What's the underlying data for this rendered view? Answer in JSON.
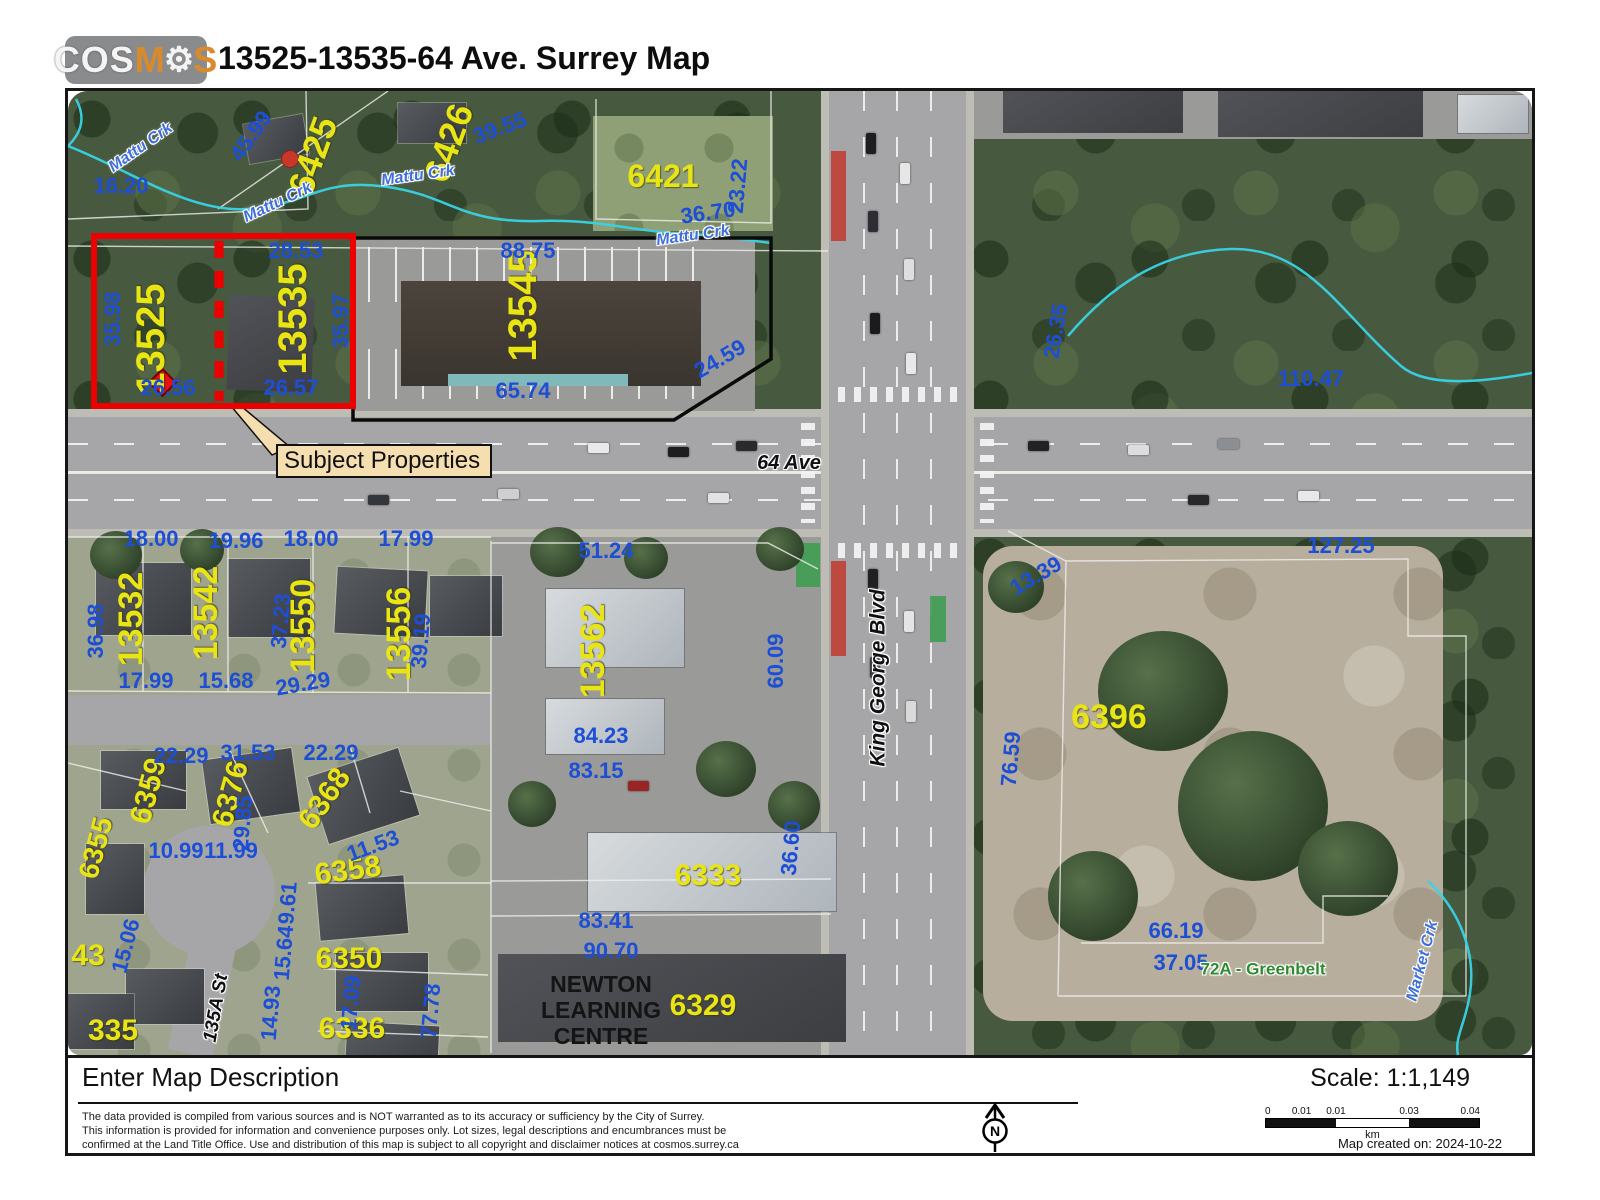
{
  "header": {
    "logo_parts": [
      {
        "t": "COS",
        "c": "lw"
      },
      {
        "t": "M",
        "c": "lo"
      },
      {
        "t": "⚙",
        "c": "lg"
      },
      {
        "t": "S",
        "c": "lo"
      }
    ],
    "title": "13525-13535-64 Ave. Surrey Map"
  },
  "map": {
    "colors": {
      "subject_outline": "#ee0000",
      "parcel_label": "#e9e414",
      "dimension_label": "#1d4ed6",
      "creek": "#39d3e6",
      "callout_fill": "#f5deb0",
      "greenbelt": "#2f8b2f"
    },
    "callout": {
      "text": "Subject Properties"
    },
    "building_label": {
      "lines": [
        "NEWTON",
        "LEARNING",
        "CENTRE"
      ]
    },
    "labels": [
      {
        "t": "6425",
        "x": 245,
        "y": 65,
        "r": -70,
        "k": "parcel",
        "s": 36
      },
      {
        "t": "6426",
        "x": 381,
        "y": 52,
        "r": -70,
        "k": "parcel",
        "s": 36
      },
      {
        "t": "6421",
        "x": 595,
        "y": 85,
        "k": "parcel",
        "s": 32
      },
      {
        "t": "13525",
        "x": 83,
        "y": 248,
        "r": -90,
        "k": "parcel",
        "s": 40
      },
      {
        "t": "13535",
        "x": 225,
        "y": 228,
        "r": -90,
        "k": "parcel",
        "s": 40
      },
      {
        "t": "13545",
        "x": 455,
        "y": 215,
        "r": -90,
        "k": "parcel",
        "s": 40
      },
      {
        "t": "13532",
        "x": 63,
        "y": 528,
        "r": -90,
        "k": "parcel",
        "s": 34
      },
      {
        "t": "13542",
        "x": 138,
        "y": 522,
        "r": -90,
        "k": "parcel",
        "s": 34
      },
      {
        "t": "13550",
        "x": 235,
        "y": 535,
        "r": -90,
        "k": "parcel",
        "s": 34
      },
      {
        "t": "13556",
        "x": 331,
        "y": 543,
        "r": -90,
        "k": "parcel",
        "s": 34
      },
      {
        "t": "13562",
        "x": 525,
        "y": 560,
        "r": -90,
        "k": "parcel",
        "s": 34
      },
      {
        "t": "6396",
        "x": 1041,
        "y": 626,
        "k": "parcel",
        "s": 34
      },
      {
        "t": "6359",
        "x": 81,
        "y": 700,
        "r": -75,
        "k": "parcel",
        "s": 30
      },
      {
        "t": "6376",
        "x": 163,
        "y": 703,
        "r": -75,
        "k": "parcel",
        "s": 30
      },
      {
        "t": "6368",
        "x": 257,
        "y": 708,
        "r": -55,
        "k": "parcel",
        "s": 30
      },
      {
        "t": "6358",
        "x": 280,
        "y": 780,
        "r": -8,
        "k": "parcel",
        "s": 30
      },
      {
        "t": "6350",
        "x": 281,
        "y": 868,
        "k": "parcel",
        "s": 30
      },
      {
        "t": "6336",
        "x": 284,
        "y": 938,
        "k": "parcel",
        "s": 30
      },
      {
        "t": "6355",
        "x": 28,
        "y": 757,
        "r": -75,
        "k": "parcel",
        "s": 28
      },
      {
        "t": "43",
        "x": 20,
        "y": 865,
        "k": "parcel",
        "s": 30
      },
      {
        "t": "335",
        "x": 45,
        "y": 940,
        "k": "parcel",
        "s": 30
      },
      {
        "t": "6333",
        "x": 640,
        "y": 785,
        "k": "parcel",
        "s": 30
      },
      {
        "t": "6329",
        "x": 635,
        "y": 915,
        "k": "parcel",
        "s": 30
      },
      {
        "t": "45.99",
        "x": 183,
        "y": 45,
        "r": -55,
        "k": "dim"
      },
      {
        "t": "16.20",
        "x": 53,
        "y": 95,
        "k": "dim"
      },
      {
        "t": "39.55",
        "x": 432,
        "y": 37,
        "r": -20,
        "k": "dim"
      },
      {
        "t": "23.22",
        "x": 670,
        "y": 95,
        "r": -85,
        "k": "dim"
      },
      {
        "t": "36.70",
        "x": 640,
        "y": 122,
        "r": -8,
        "k": "dim"
      },
      {
        "t": "88.75",
        "x": 460,
        "y": 160,
        "k": "dim"
      },
      {
        "t": "28.53",
        "x": 228,
        "y": 160,
        "k": "dim"
      },
      {
        "t": "35.98",
        "x": 45,
        "y": 228,
        "r": -90,
        "k": "dim"
      },
      {
        "t": "35.97",
        "x": 273,
        "y": 230,
        "r": -90,
        "k": "dim"
      },
      {
        "t": "26.56",
        "x": 100,
        "y": 297,
        "k": "dim"
      },
      {
        "t": "26.57",
        "x": 223,
        "y": 297,
        "k": "dim"
      },
      {
        "t": "65.74",
        "x": 455,
        "y": 300,
        "k": "dim"
      },
      {
        "t": "24.59",
        "x": 652,
        "y": 268,
        "r": -30,
        "k": "dim"
      },
      {
        "t": "26.35",
        "x": 988,
        "y": 240,
        "r": -80,
        "k": "dim"
      },
      {
        "t": "110.47",
        "x": 1243,
        "y": 288,
        "k": "dim"
      },
      {
        "t": "18.00",
        "x": 83,
        "y": 448,
        "k": "dim"
      },
      {
        "t": "19.96",
        "x": 168,
        "y": 450,
        "k": "dim"
      },
      {
        "t": "18.00",
        "x": 243,
        "y": 448,
        "k": "dim"
      },
      {
        "t": "17.99",
        "x": 338,
        "y": 448,
        "k": "dim"
      },
      {
        "t": "51.24",
        "x": 538,
        "y": 460,
        "k": "dim"
      },
      {
        "t": "36.98",
        "x": 28,
        "y": 540,
        "r": -90,
        "k": "dim"
      },
      {
        "t": "37.23",
        "x": 213,
        "y": 530,
        "r": -85,
        "k": "dim"
      },
      {
        "t": "39.19",
        "x": 353,
        "y": 550,
        "r": -85,
        "k": "dim"
      },
      {
        "t": "17.99",
        "x": 78,
        "y": 590,
        "k": "dim"
      },
      {
        "t": "15.68",
        "x": 158,
        "y": 590,
        "k": "dim"
      },
      {
        "t": "29.29",
        "x": 235,
        "y": 593,
        "r": -10,
        "k": "dim"
      },
      {
        "t": "60.09",
        "x": 708,
        "y": 570,
        "r": -90,
        "k": "dim"
      },
      {
        "t": "13.39",
        "x": 968,
        "y": 485,
        "r": -30,
        "k": "dim"
      },
      {
        "t": "127.25",
        "x": 1273,
        "y": 455,
        "k": "dim"
      },
      {
        "t": "84.23",
        "x": 533,
        "y": 645,
        "k": "dim"
      },
      {
        "t": "83.15",
        "x": 528,
        "y": 680,
        "k": "dim"
      },
      {
        "t": "76.59",
        "x": 943,
        "y": 668,
        "r": -85,
        "k": "dim"
      },
      {
        "t": "22.29",
        "x": 113,
        "y": 665,
        "k": "dim"
      },
      {
        "t": "31.53",
        "x": 180,
        "y": 662,
        "k": "dim"
      },
      {
        "t": "22.29",
        "x": 263,
        "y": 662,
        "k": "dim"
      },
      {
        "t": "29.85",
        "x": 175,
        "y": 732,
        "r": -85,
        "k": "dim"
      },
      {
        "t": "10.99",
        "x": 108,
        "y": 760,
        "k": "dim"
      },
      {
        "t": "11.99",
        "x": 163,
        "y": 760,
        "k": "dim"
      },
      {
        "t": "11.53",
        "x": 305,
        "y": 755,
        "r": -20,
        "k": "dim"
      },
      {
        "t": "9.61",
        "x": 220,
        "y": 812,
        "r": -85,
        "k": "dim"
      },
      {
        "t": "15.64",
        "x": 216,
        "y": 862,
        "r": -85,
        "k": "dim"
      },
      {
        "t": "15.06",
        "x": 58,
        "y": 855,
        "r": -75,
        "k": "dim"
      },
      {
        "t": "14.93",
        "x": 203,
        "y": 922,
        "r": -85,
        "k": "dim"
      },
      {
        "t": "17.09",
        "x": 283,
        "y": 912,
        "r": -85,
        "k": "dim"
      },
      {
        "t": "77.78",
        "x": 363,
        "y": 920,
        "r": -85,
        "k": "dim"
      },
      {
        "t": "83.41",
        "x": 538,
        "y": 830,
        "k": "dim"
      },
      {
        "t": "90.70",
        "x": 543,
        "y": 860,
        "k": "dim"
      },
      {
        "t": "36.60",
        "x": 723,
        "y": 757,
        "r": -85,
        "k": "dim"
      },
      {
        "t": "66.19",
        "x": 1108,
        "y": 840,
        "k": "dim"
      },
      {
        "t": "37.05",
        "x": 1113,
        "y": 872,
        "k": "dim"
      },
      {
        "t": "Mattu Crk",
        "x": 73,
        "y": 57,
        "r": -35,
        "k": "creek"
      },
      {
        "t": "Mattu Crk",
        "x": 210,
        "y": 112,
        "r": -25,
        "k": "creek"
      },
      {
        "t": "Mattu Crk",
        "x": 350,
        "y": 85,
        "r": -8,
        "k": "creek"
      },
      {
        "t": "Mattu Crk",
        "x": 625,
        "y": 145,
        "r": -8,
        "k": "creek"
      },
      {
        "t": "Market Crk",
        "x": 1355,
        "y": 870,
        "r": -75,
        "k": "creek"
      },
      {
        "t": "64 Ave",
        "x": 721,
        "y": 372,
        "k": "roadlbl"
      },
      {
        "t": "King George Blvd",
        "x": 810,
        "y": 587,
        "r": -90,
        "k": "roadlbl",
        "s": 21
      },
      {
        "t": "135A St",
        "x": 148,
        "y": 917,
        "r": -80,
        "k": "roadlbl",
        "s": 19
      },
      {
        "t": "72A - Greenbelt",
        "x": 1195,
        "y": 878,
        "k": "greenlbl"
      }
    ]
  },
  "footer": {
    "description": "Enter Map Description",
    "disclaimer_lines": [
      "The data provided is compiled from various sources and is NOT warranted as to its accuracy or sufficiency by the City of Surrey.",
      "This information is provided for information and convenience purposes only.  Lot sizes, legal descriptions and encumbrances must be",
      "confirmed at the Land Title Office.  Use and distribution of this map is subject to all copyright and disclaimer notices at cosmos.surrey.ca"
    ],
    "scale_label": "Scale:  1:1,149",
    "north": "N",
    "scalebar": {
      "ticks": [
        {
          "t": "0",
          "p": 0
        },
        {
          "t": "0.01",
          "p": 17
        },
        {
          "t": "0.01",
          "p": 33
        },
        {
          "t": "0.03",
          "p": 67
        },
        {
          "t": "0.04",
          "p": 100
        }
      ],
      "unit": "km"
    },
    "created": "Map created on: 2024-10-22"
  }
}
